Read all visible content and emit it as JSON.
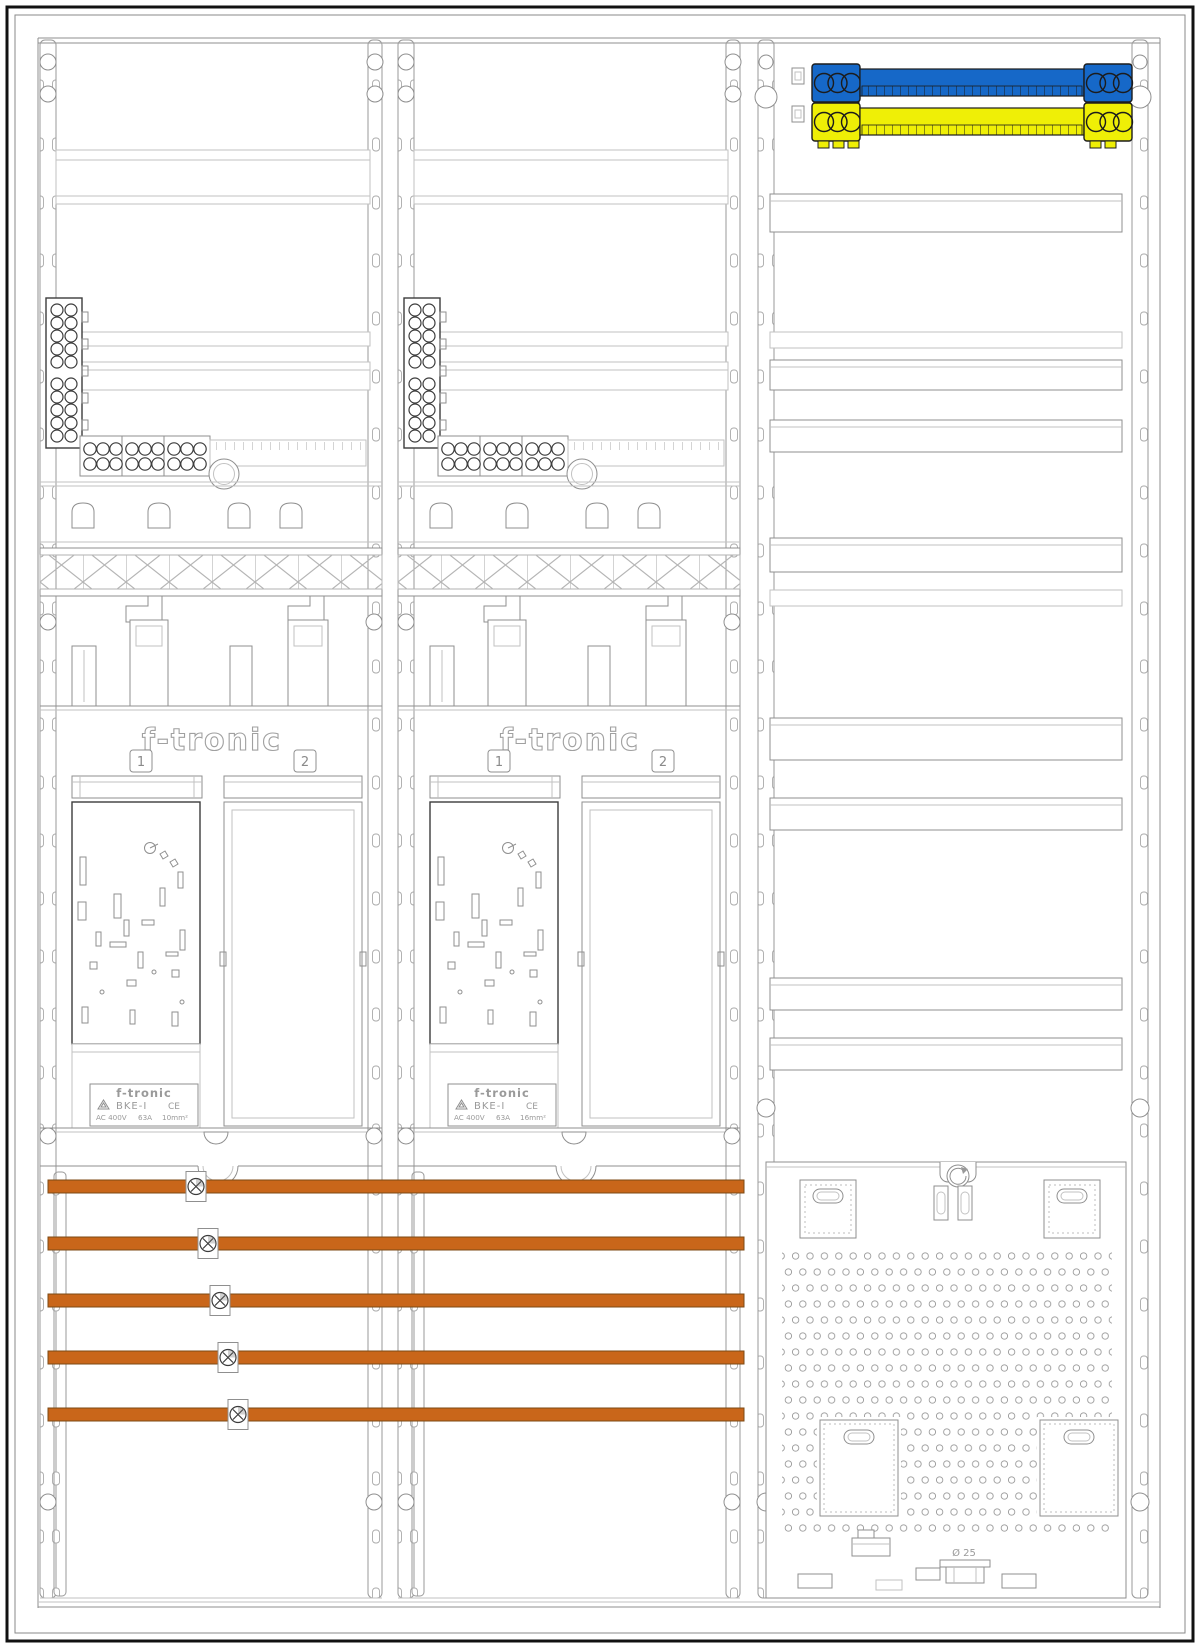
{
  "title": "Three-field meter cabinet assembly drawing",
  "colors": {
    "background": "#ffffff",
    "line_dark": "#3c3c3c",
    "line_mid": "#8f8f8f",
    "line_light": "#c2c2c2",
    "busbar_neutral_blue": "#1668c8",
    "busbar_pe_yellow": "#efef06",
    "busbar_phase_copper": "#c9661a"
  },
  "meter_fields": [
    {
      "brand_logo": "f-tronic",
      "position_badges": [
        "1",
        "2"
      ],
      "type_label": {
        "brand": "f-tronic",
        "model": "BKE-I",
        "ce_mark": "CE",
        "voltage": "AC 400V",
        "current": "63A",
        "cross_section": "10mm²"
      }
    },
    {
      "brand_logo": "f-tronic",
      "position_badges": [
        "1",
        "2"
      ],
      "type_label": {
        "brand": "f-tronic",
        "model": "BKE-I",
        "ce_mark": "CE",
        "voltage": "AC 400V",
        "current": "63A",
        "cross_section": "16mm²"
      }
    }
  ],
  "distribution": {
    "phase_busbar_count": 5
  },
  "right_field": {
    "knockout_label": "Ø 25"
  }
}
